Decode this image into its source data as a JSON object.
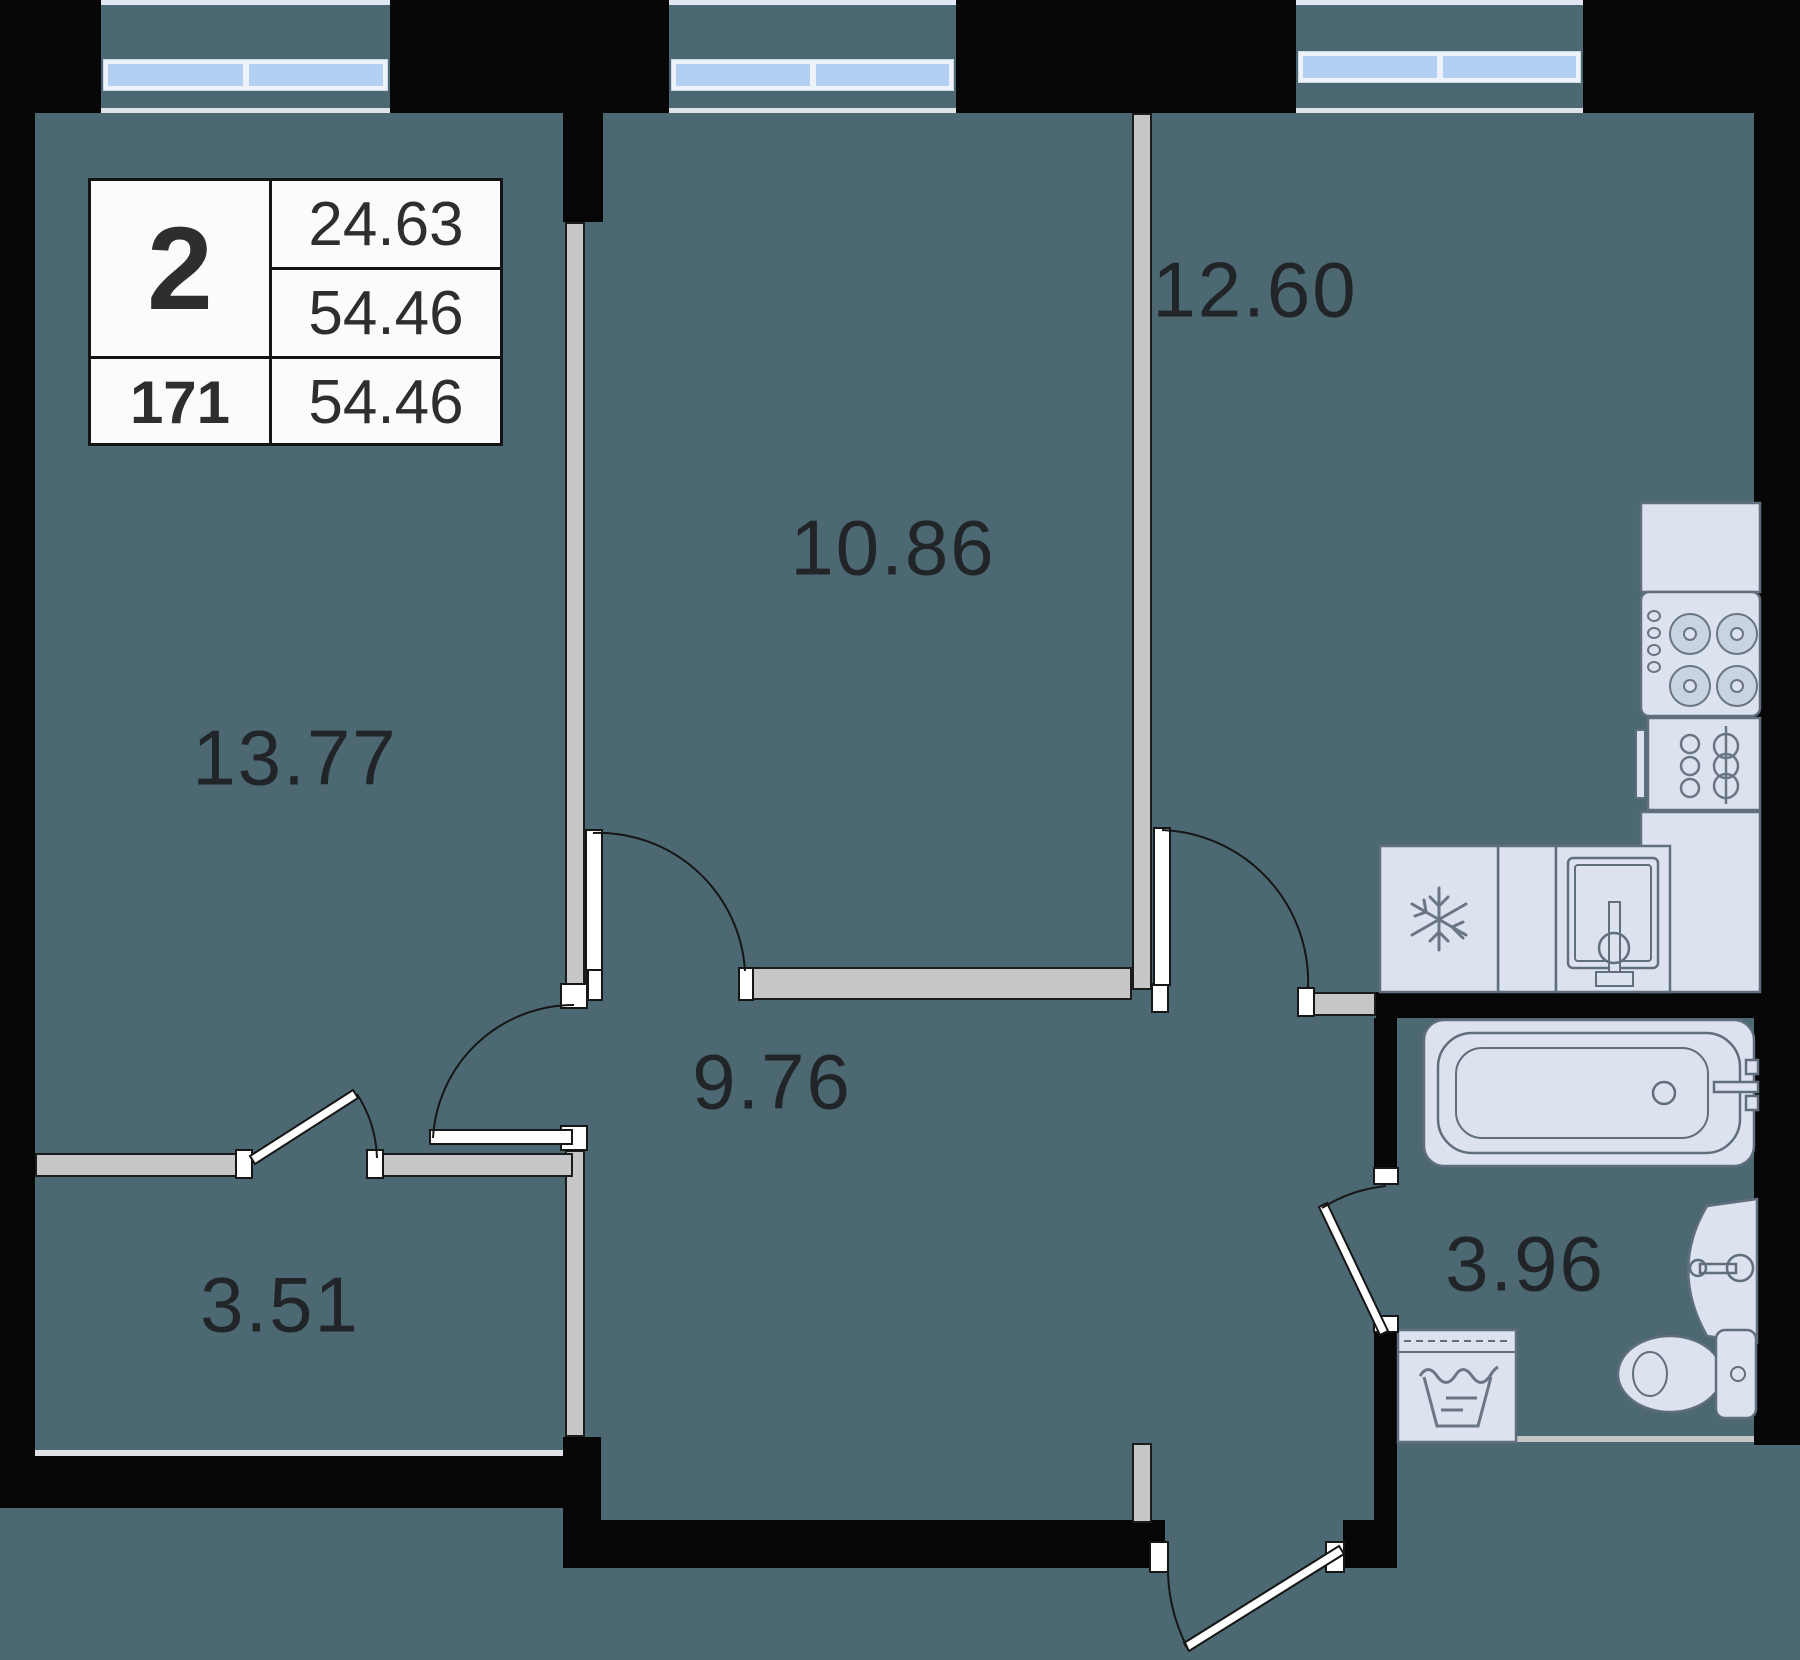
{
  "plan": {
    "title": "apartment-floor-plan",
    "info_box": {
      "rooms_count": "2",
      "living_area": "24.63",
      "total_area": "54.46",
      "unit_number": "171",
      "total_area_repeat": "54.46"
    },
    "room_labels": [
      {
        "name": "living-room",
        "area": "13.77"
      },
      {
        "name": "bedroom",
        "area": "10.86"
      },
      {
        "name": "kitchen",
        "area": "12.60"
      },
      {
        "name": "hallway",
        "area": "9.76"
      },
      {
        "name": "wardrobe",
        "area": "3.51"
      },
      {
        "name": "bathroom",
        "area": "3.96"
      }
    ],
    "fixtures": [
      "bay-window",
      "stove",
      "oven",
      "fridge",
      "kitchen-sink",
      "bathtub",
      "wash-basin",
      "washing-machine",
      "toilet",
      "door-swing"
    ],
    "colors": {
      "floor": "#4c6872",
      "wall": "#060606",
      "partition": "#c6c7c8",
      "fixture_fill": "#dce3ee",
      "fixture_stroke": "#606e7d",
      "window_glass": "#b3cff2",
      "window_frame": "#eef2f9",
      "label_text": "#222527"
    }
  }
}
